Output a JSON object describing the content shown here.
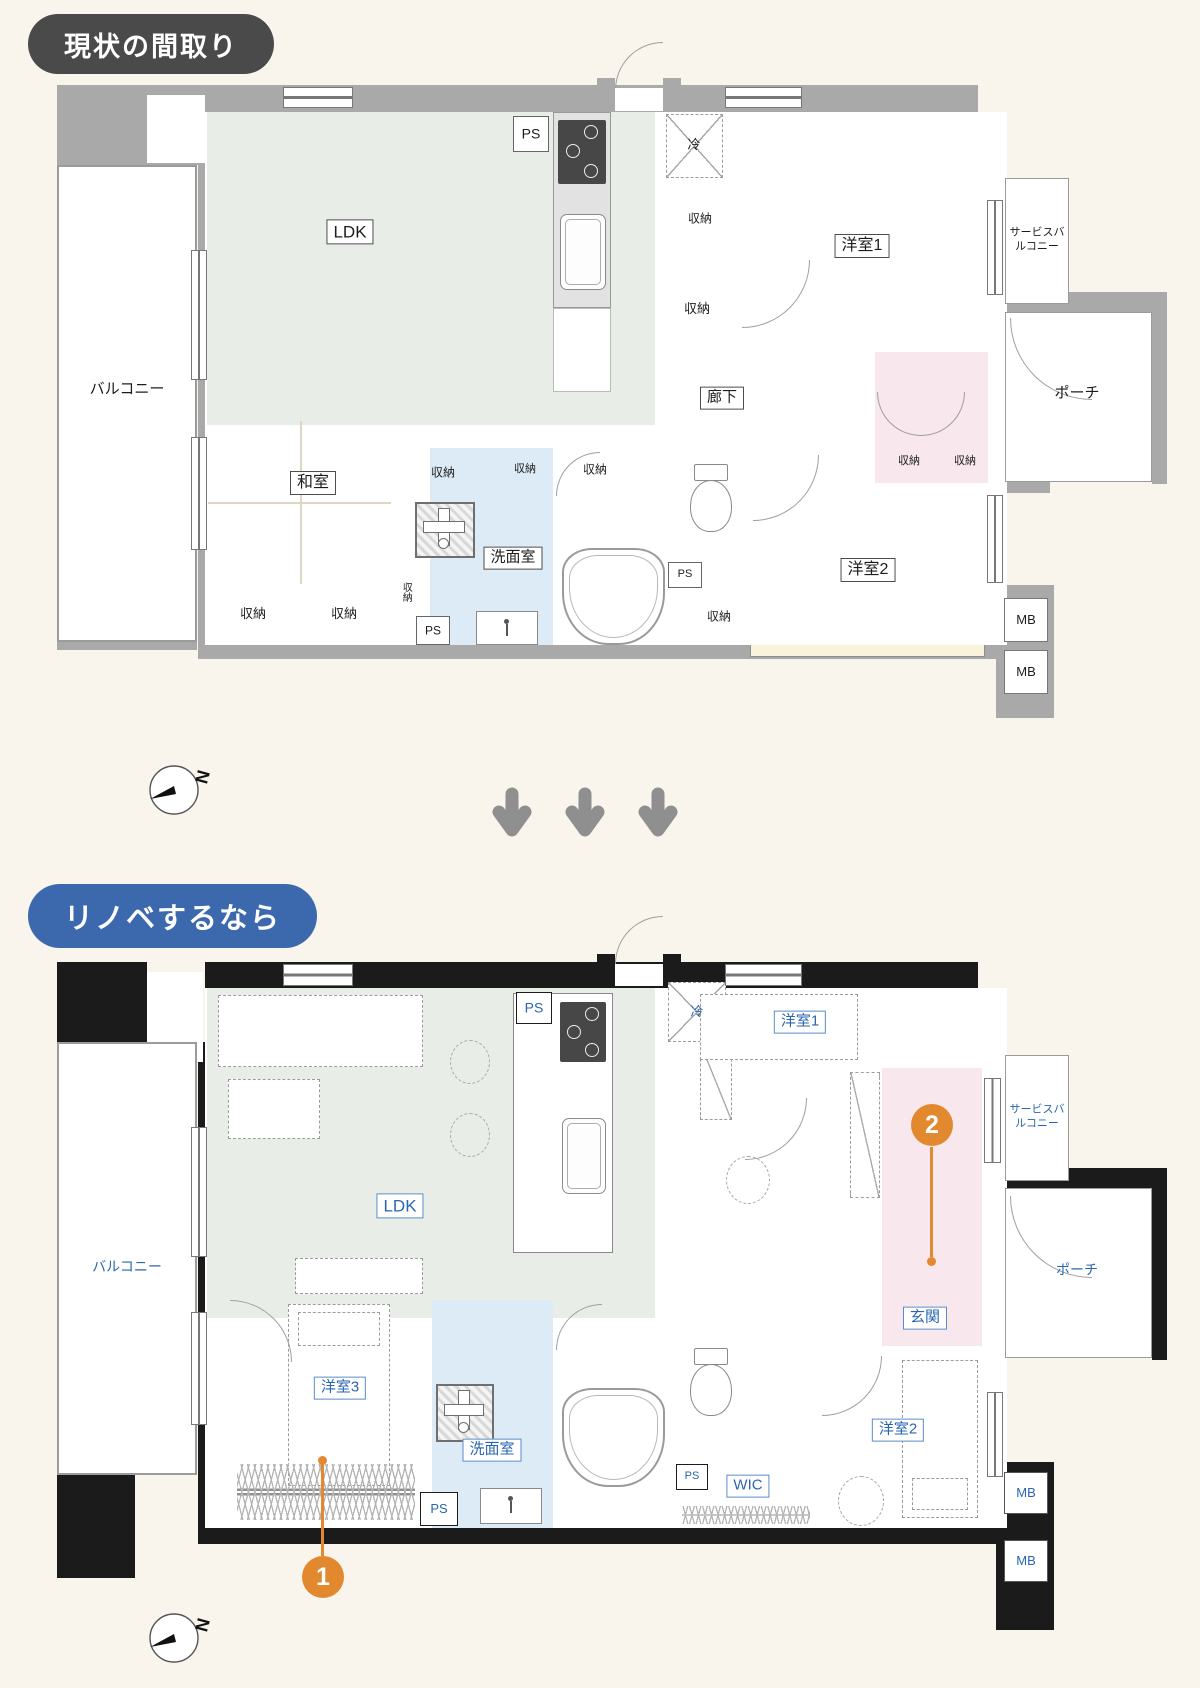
{
  "badges": {
    "current": "現状の間取り",
    "reno": "リノベするなら"
  },
  "terms": {
    "ldk": "LDK",
    "balcony": "バルコニー",
    "service_balcony": "サービスバルコニー",
    "porch": "ポーチ",
    "corridor": "廊下",
    "japanese_room": "和室",
    "western1": "洋室1",
    "western2": "洋室2",
    "western3": "洋室3",
    "washroom": "洗面室",
    "entrance": "玄関",
    "wic": "WIC",
    "storage": "収納",
    "fridge": "冷",
    "ps": "PS",
    "mb": "MB",
    "north": "N"
  },
  "markers": {
    "m1": "1",
    "m2": "2"
  },
  "colors": {
    "background": "#f9f5ec",
    "wall_current": "#a9a9a9",
    "wall_reno": "#1b1b1b",
    "ldk_green": "#e8eee7",
    "room_cream": "#faf3dc",
    "storage_green": "#e5eae1",
    "storage_blue": "#dbe9f4",
    "washroom_blue": "#dcebf6",
    "entrance_pink": "#f8e7ec",
    "label_blue": "#2a66b0",
    "marker_orange": "#e2892f",
    "badge_dark": "#4a4a4a",
    "badge_blue": "#3c69ae",
    "arrow_gray": "#8f8f8f"
  }
}
